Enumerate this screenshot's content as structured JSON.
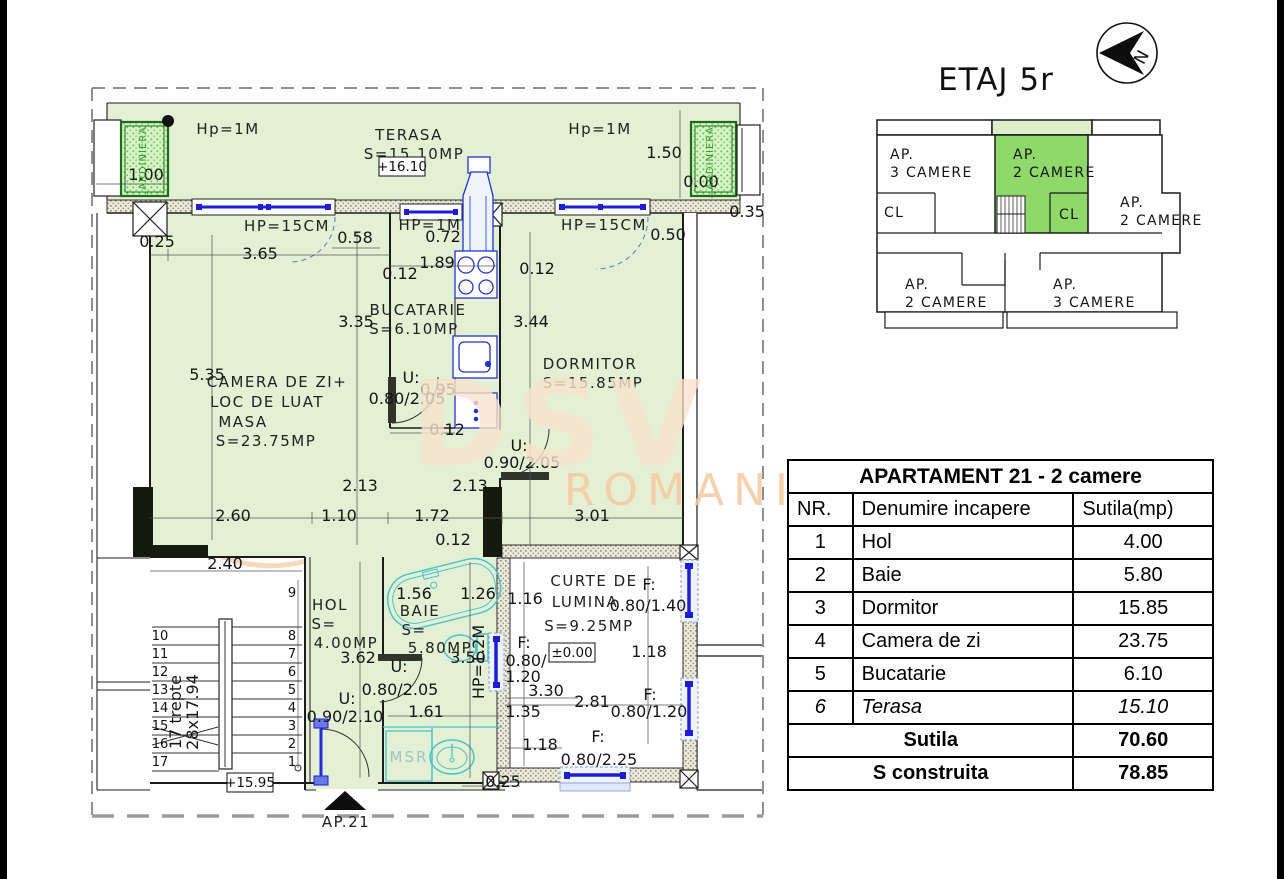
{
  "header": {
    "title": "ETAJ 5r",
    "north_letter": "N"
  },
  "key_plan": {
    "texts": [
      {
        "t": "AP.",
        "x": 890,
        "y": 159
      },
      {
        "t": "3 CAMERE",
        "x": 890,
        "y": 177
      },
      {
        "t": "AP.",
        "x": 1013,
        "y": 159
      },
      {
        "t": "2 CAMERE",
        "x": 1013,
        "y": 177
      },
      {
        "t": "CL",
        "x": 884,
        "y": 217
      },
      {
        "t": "CL",
        "x": 1059,
        "y": 219
      },
      {
        "t": "AP.",
        "x": 1120,
        "y": 207
      },
      {
        "t": "2 CAMERE",
        "x": 1120,
        "y": 225
      },
      {
        "t": "AP.",
        "x": 905,
        "y": 289
      },
      {
        "t": "2 CAMERE",
        "x": 905,
        "y": 307
      },
      {
        "t": "AP.",
        "x": 1053,
        "y": 289
      },
      {
        "t": "3 CAMERE",
        "x": 1053,
        "y": 307
      }
    ],
    "highlight_color": "#8ed96a",
    "strip_color": "#dcefca"
  },
  "table": {
    "title": "APARTAMENT 21 - 2 camere",
    "columns": [
      "NR.",
      "Denumire incapere",
      "Sutila(mp)"
    ],
    "rows": [
      {
        "nr": "1",
        "name": "Hol",
        "area": "4.00"
      },
      {
        "nr": "2",
        "name": "Baie",
        "area": "5.80"
      },
      {
        "nr": "3",
        "name": "Dormitor",
        "area": "15.85"
      },
      {
        "nr": "4",
        "name": "Camera de zi",
        "area": "23.75"
      },
      {
        "nr": "5",
        "name": "Bucatarie",
        "area": "6.10"
      },
      {
        "nr": "6",
        "name": "Terasa",
        "area": "15.10",
        "italic": true
      }
    ],
    "summary": [
      {
        "label": "Sutila",
        "value": "70.60"
      },
      {
        "label": "S construita",
        "value": "78.85"
      }
    ]
  },
  "plan": {
    "levels": [
      {
        "t": "+16.10",
        "x": 402,
        "y": 171
      },
      {
        "t": "±0.00",
        "x": 572,
        "y": 657
      },
      {
        "t": "+15.95",
        "x": 250,
        "y": 787
      }
    ],
    "stairs": {
      "left": [
        "10",
        "11",
        "12",
        "13",
        "14",
        "15",
        "16",
        "17"
      ],
      "right": [
        "8",
        "7",
        "6",
        "5",
        "4",
        "3",
        "2",
        "1"
      ],
      "first": "9"
    },
    "texts": [
      {
        "t": "Hp=1M",
        "x": 228,
        "y": 134,
        "c": "lab",
        "s": 14
      },
      {
        "t": "TERASA",
        "x": 409,
        "y": 140,
        "c": "lab"
      },
      {
        "t": "S=15.10MP",
        "x": 414,
        "y": 159,
        "c": "lab",
        "s": 14
      },
      {
        "t": "Hp=1M",
        "x": 600,
        "y": 134,
        "c": "lab",
        "s": 14
      },
      {
        "t": "1.00",
        "x": 146,
        "y": 180,
        "c": "dim"
      },
      {
        "t": "1.50",
        "x": 664,
        "y": 158,
        "c": "dim"
      },
      {
        "t": "0.00",
        "x": 701,
        "y": 187,
        "c": "dim"
      },
      {
        "t": "0.35",
        "x": 747,
        "y": 217,
        "c": "dim"
      },
      {
        "t": "JARDINIERA",
        "x": 146,
        "y": 160,
        "c": "green",
        "r": -90
      },
      {
        "t": "JARDINIERA",
        "x": 713,
        "y": 160,
        "c": "green",
        "r": -90
      },
      {
        "t": "HP=15CM",
        "x": 287,
        "y": 231,
        "c": "lab",
        "s": 13
      },
      {
        "t": "HP=1M",
        "x": 430,
        "y": 230,
        "c": "lab",
        "s": 13
      },
      {
        "t": "HP=15CM",
        "x": 604,
        "y": 230,
        "c": "lab",
        "s": 13
      },
      {
        "t": "0.25",
        "x": 157,
        "y": 247,
        "c": "dim"
      },
      {
        "t": "3.65",
        "x": 260,
        "y": 259,
        "c": "dim"
      },
      {
        "t": "0.58",
        "x": 355,
        "y": 243,
        "c": "dim"
      },
      {
        "t": "0.72",
        "x": 443,
        "y": 242,
        "c": "dim"
      },
      {
        "t": "0.50",
        "x": 668,
        "y": 240,
        "c": "dim"
      },
      {
        "t": "1.89",
        "x": 437,
        "y": 268,
        "c": "dim"
      },
      {
        "t": "0.12",
        "x": 400,
        "y": 279,
        "c": "dim"
      },
      {
        "t": "0.12",
        "x": 537,
        "y": 274,
        "c": "dim"
      },
      {
        "t": "BUCATARIE",
        "x": 418,
        "y": 315,
        "c": "lab"
      },
      {
        "t": "S=6.10MP",
        "x": 414,
        "y": 334,
        "c": "lab"
      },
      {
        "t": "3.35",
        "x": 356,
        "y": 327,
        "c": "dim"
      },
      {
        "t": "3.44",
        "x": 531,
        "y": 327,
        "c": "dim"
      },
      {
        "t": "U:",
        "x": 411,
        "y": 383,
        "c": "dim"
      },
      {
        "t": "0.80/2.05",
        "x": 407,
        "y": 404,
        "c": "dim"
      },
      {
        "t": "0.95",
        "x": 438,
        "y": 395,
        "c": "dim"
      },
      {
        "t": "0.12",
        "x": 447,
        "y": 435,
        "c": "dim"
      },
      {
        "t": "DORMITOR",
        "x": 590,
        "y": 369,
        "c": "lab"
      },
      {
        "t": "S=15.85MP",
        "x": 593,
        "y": 388,
        "c": "lab"
      },
      {
        "t": "U:",
        "x": 519,
        "y": 451,
        "c": "dim"
      },
      {
        "t": "0.90/2.05",
        "x": 522,
        "y": 468,
        "c": "dim"
      },
      {
        "t": "3.01",
        "x": 592,
        "y": 521,
        "c": "dim"
      },
      {
        "t": "5.35",
        "x": 207,
        "y": 380,
        "c": "dim"
      },
      {
        "t": "CAMERA DE ZI+",
        "x": 277,
        "y": 387,
        "c": "lab"
      },
      {
        "t": "LOC DE LUAT",
        "x": 267,
        "y": 407,
        "c": "lab"
      },
      {
        "t": "MASA",
        "x": 243,
        "y": 427,
        "c": "lab"
      },
      {
        "t": "S=23.75MP",
        "x": 266,
        "y": 446,
        "c": "lab"
      },
      {
        "t": "2.13",
        "x": 360,
        "y": 491,
        "c": "dim"
      },
      {
        "t": "2.13",
        "x": 470,
        "y": 491,
        "c": "dim"
      },
      {
        "t": "2.60",
        "x": 233,
        "y": 521,
        "c": "dim"
      },
      {
        "t": "1.10",
        "x": 339,
        "y": 521,
        "c": "dim"
      },
      {
        "t": "1.72",
        "x": 432,
        "y": 521,
        "c": "dim"
      },
      {
        "t": "0.12",
        "x": 453,
        "y": 545,
        "c": "dim"
      },
      {
        "t": "HOL",
        "x": 330,
        "y": 610,
        "c": "lab"
      },
      {
        "t": "S=",
        "x": 324,
        "y": 629,
        "c": "lab"
      },
      {
        "t": "4.00MP",
        "x": 346,
        "y": 648,
        "c": "lab"
      },
      {
        "t": "1.56",
        "x": 414,
        "y": 599,
        "c": "dim"
      },
      {
        "t": "1.26",
        "x": 478,
        "y": 599,
        "c": "dim"
      },
      {
        "t": "BAIE",
        "x": 420,
        "y": 616,
        "c": "lab"
      },
      {
        "t": "S=",
        "x": 414,
        "y": 635,
        "c": "lab"
      },
      {
        "t": "5.80MP",
        "x": 440,
        "y": 653,
        "c": "lab"
      },
      {
        "t": "3.62",
        "x": 358,
        "y": 663,
        "c": "dim"
      },
      {
        "t": "3.50",
        "x": 468,
        "y": 663,
        "c": "dim"
      },
      {
        "t": "HP=1.2M",
        "x": 484,
        "y": 662,
        "c": "dim",
        "r": -90,
        "s": 11
      },
      {
        "t": "U:",
        "x": 399,
        "y": 672,
        "c": "dim"
      },
      {
        "t": "0.80/2.05",
        "x": 400,
        "y": 695,
        "c": "dim"
      },
      {
        "t": "U:",
        "x": 347,
        "y": 704,
        "c": "dim"
      },
      {
        "t": "0.90/2.10",
        "x": 345,
        "y": 722,
        "c": "dim"
      },
      {
        "t": "1.61",
        "x": 426,
        "y": 717,
        "c": "dim"
      },
      {
        "t": "MSR",
        "x": 409,
        "y": 762,
        "c": "cyan"
      },
      {
        "t": "0.25",
        "x": 503,
        "y": 787,
        "c": "dim"
      },
      {
        "t": "AP.21",
        "x": 346,
        "y": 827,
        "c": "lab",
        "s": 17
      },
      {
        "t": "CURTE DE",
        "x": 594,
        "y": 586,
        "c": "lab"
      },
      {
        "t": "LUMINA",
        "x": 585,
        "y": 607,
        "c": "lab"
      },
      {
        "t": "S=9.25MP",
        "x": 589,
        "y": 631,
        "c": "lab"
      },
      {
        "t": "1.16",
        "x": 525,
        "y": 604,
        "c": "dim"
      },
      {
        "t": "F:",
        "x": 649,
        "y": 590,
        "c": "dim"
      },
      {
        "t": "0.80/1.40",
        "x": 648,
        "y": 611,
        "c": "dim"
      },
      {
        "t": "1.18",
        "x": 649,
        "y": 657,
        "c": "dim"
      },
      {
        "t": "F:",
        "x": 524,
        "y": 648,
        "c": "dim"
      },
      {
        "t": "0.80/",
        "x": 526,
        "y": 666,
        "c": "dim"
      },
      {
        "t": "1.20",
        "x": 523,
        "y": 682,
        "c": "dim"
      },
      {
        "t": "3.30",
        "x": 546,
        "y": 696,
        "c": "dim"
      },
      {
        "t": "2.81",
        "x": 592,
        "y": 707,
        "c": "dim"
      },
      {
        "t": "1.35",
        "x": 523,
        "y": 717,
        "c": "dim"
      },
      {
        "t": "F:",
        "x": 650,
        "y": 700,
        "c": "dim"
      },
      {
        "t": "0.80/1.20",
        "x": 649,
        "y": 717,
        "c": "dim"
      },
      {
        "t": "1.18",
        "x": 540,
        "y": 750,
        "c": "dim"
      },
      {
        "t": "F:",
        "x": 598,
        "y": 742,
        "c": "dim"
      },
      {
        "t": "0.80/2.25",
        "x": 599,
        "y": 765,
        "c": "dim"
      },
      {
        "t": "2.40",
        "x": 225,
        "y": 569,
        "c": "dim"
      },
      {
        "t": "17 trepte",
        "x": 181,
        "y": 712,
        "c": "dim",
        "r": -90,
        "s": 12
      },
      {
        "t": "28x17.94",
        "x": 198,
        "y": 712,
        "c": "dim",
        "r": -90,
        "s": 12
      },
      {
        "t": "DSV",
        "x": 560,
        "y": 465,
        "c": "wm1"
      },
      {
        "t": "ROMANIA",
        "x": 700,
        "y": 505,
        "c": "wm2"
      }
    ]
  }
}
